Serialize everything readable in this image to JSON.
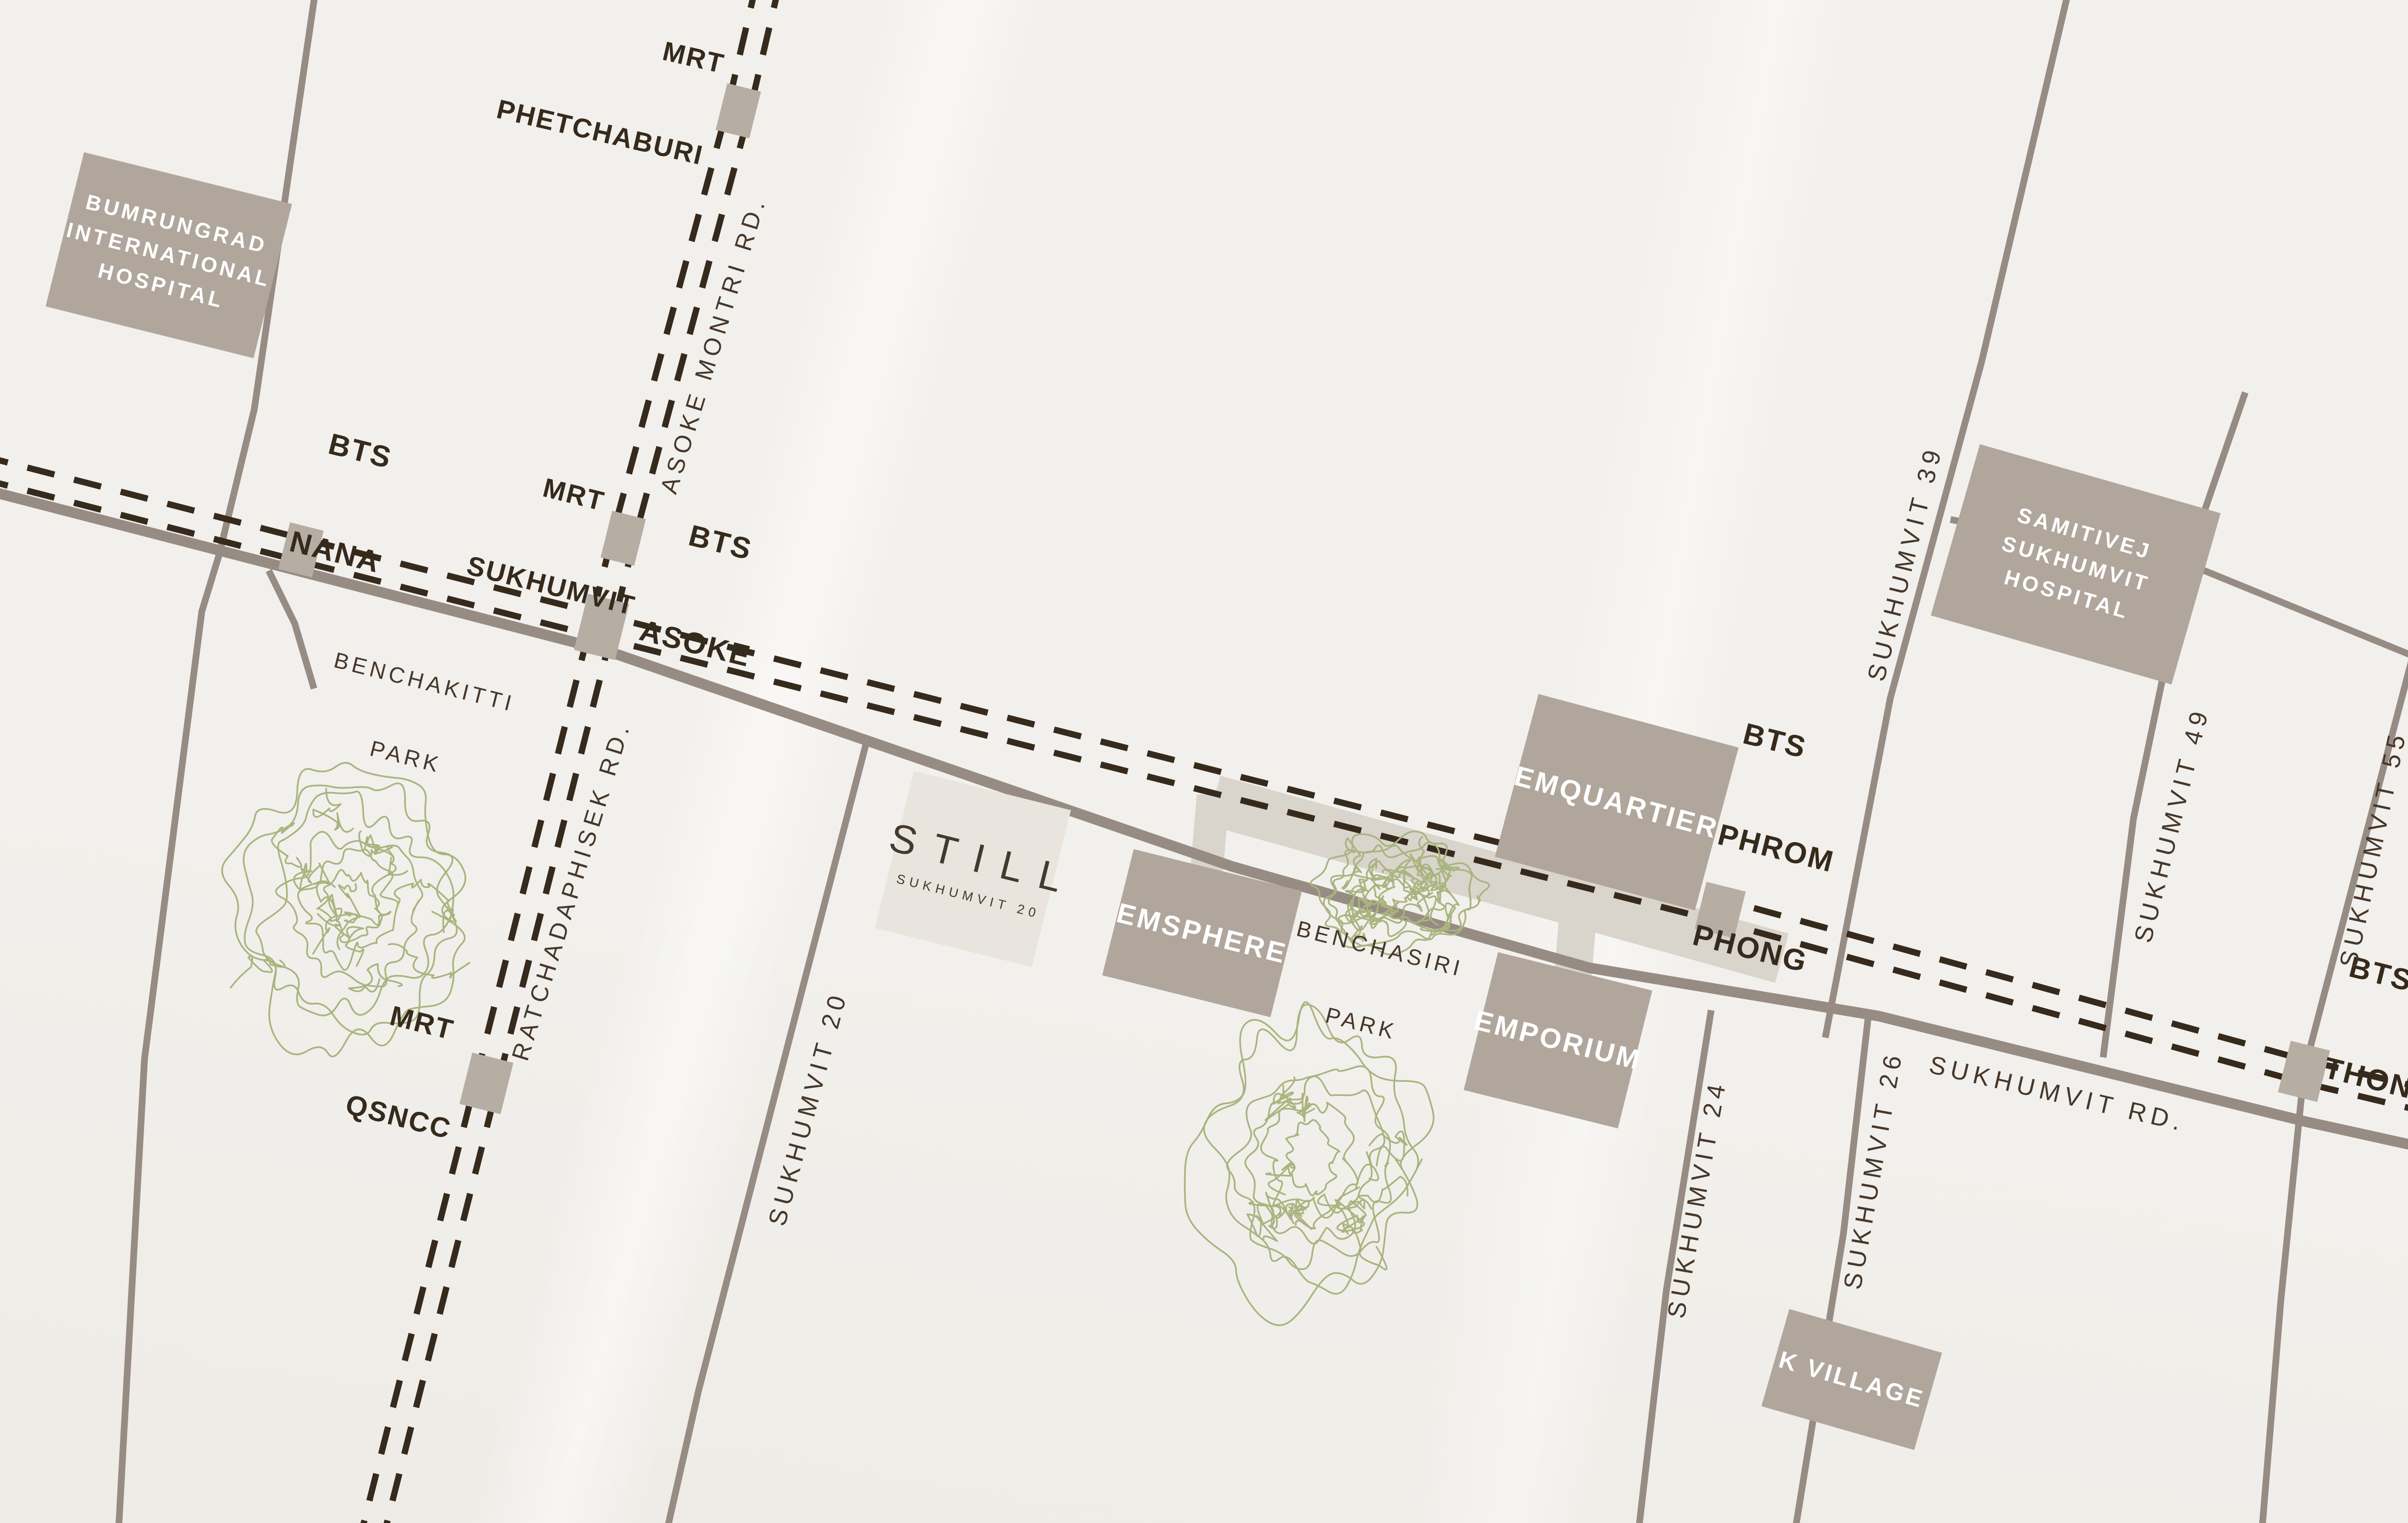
{
  "colors": {
    "background": "#f2f0ec",
    "road": "#978c83",
    "rail": "#362a1d",
    "skywalk_band": "#d9d4cc",
    "building": "#b0a69c",
    "station": "#b6ada3",
    "still_box": "#e9e5de",
    "still_text": "#43392e",
    "station_label": "#362a1c",
    "road_label": "#46372a",
    "tree": "#a9b47f",
    "building_text": "#ffffff"
  },
  "stations": [
    {
      "id": "mrt-phetchaburi",
      "lines": [
        "MRT",
        "PHETCHABURI"
      ]
    },
    {
      "id": "bts-nana",
      "lines": [
        "BTS",
        "NANA"
      ]
    },
    {
      "id": "mrt-sukhumvit",
      "lines": [
        "MRT",
        "SUKHUMVIT"
      ]
    },
    {
      "id": "bts-asoke",
      "lines": [
        "BTS",
        "ASOKE"
      ]
    },
    {
      "id": "mrt-qsncc",
      "lines": [
        "MRT",
        "QSNCC"
      ]
    },
    {
      "id": "bts-phrom-phong",
      "lines": [
        "BTS",
        "PHROM",
        "PHONG"
      ]
    },
    {
      "id": "bts-thonglo",
      "lines": [
        "BTS",
        "THONGLO"
      ]
    }
  ],
  "buildings": [
    {
      "id": "bumrungrad",
      "lines": [
        "BUMRUNGRAD",
        "INTERNATIONAL",
        "HOSPITAL"
      ]
    },
    {
      "id": "samitivej",
      "lines": [
        "SAMITIVEJ",
        "SUKHUMVIT",
        "HOSPITAL"
      ]
    },
    {
      "id": "emquartier",
      "lines": [
        "EMQUARTIER"
      ]
    },
    {
      "id": "emsphere",
      "lines": [
        "EMSPHERE"
      ]
    },
    {
      "id": "emporium",
      "lines": [
        "EMPORIUM"
      ]
    },
    {
      "id": "kvillage",
      "lines": [
        "K VILLAGE"
      ]
    }
  ],
  "property": {
    "name": "STILL",
    "subtitle": "SUKHUMVIT 20"
  },
  "parks": [
    {
      "id": "benchakitti",
      "lines": [
        "BENCHAKITTI",
        "PARK"
      ]
    },
    {
      "id": "benchasiri",
      "lines": [
        "BENCHASIRI",
        "PARK"
      ]
    }
  ],
  "roads": [
    {
      "id": "asoke-montri",
      "label": "ASOKE MONTRI RD."
    },
    {
      "id": "ratchadaphisek",
      "label": "RATCHADAPHISEK RD."
    },
    {
      "id": "sukhumvit-20",
      "label": "SUKHUMVIT 20"
    },
    {
      "id": "sukhumvit-24",
      "label": "SUKHUMVIT 24"
    },
    {
      "id": "sukhumvit-26",
      "label": "SUKHUMVIT 26"
    },
    {
      "id": "sukhumvit-39",
      "label": "SUKHUMVIT 39"
    },
    {
      "id": "sukhumvit-49",
      "label": "SUKHUMVIT 49"
    },
    {
      "id": "sukhumvit-55",
      "label": "SUKHUMVIT 55"
    },
    {
      "id": "sukhumvit-rd",
      "label": "SUKHUMVIT RD."
    }
  ]
}
